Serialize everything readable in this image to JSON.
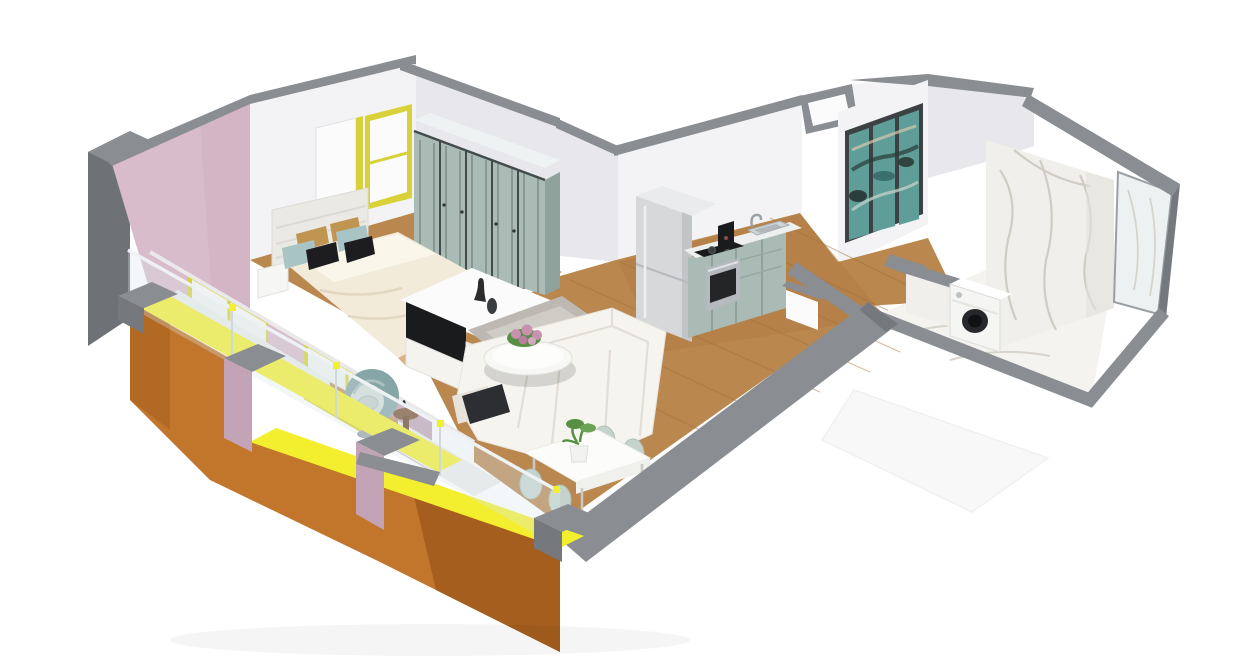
{
  "scene": {
    "title": "Isometric 3D apartment floor plan render",
    "rooms": {
      "bedroom": "Bedroom",
      "living": "Living room",
      "kitchen": "Kitchen",
      "hallway": "Hallway",
      "bathroom": "Bathroom",
      "balcony": "Balcony"
    },
    "furniture": {
      "bed": "Double bed with cream duvet and pillows",
      "wardrobe": "Five-door sage wardrobe",
      "tv": "Wall TV on white media unit",
      "sofa": "White L-shaped sofa",
      "coffee_table": "Round coffee table with pink flowers",
      "dining": "White dining table with four chairs and plant",
      "fridge": "Tall fridge-freezer",
      "kitchen_run": "Kitchen counter with sink, hob and oven",
      "painting": "Teal abstract triptych painting",
      "washer": "Washing machine",
      "egg_chair": "Round egg chair",
      "side_table": "Balcony side table"
    }
  },
  "colors": {
    "bg": "#ffffff",
    "wallWhite": "#f3f3f5",
    "wallBright": "#fbfbfc",
    "wallShade": "#e8e8ec",
    "wallTop": "#8a8d92",
    "wallTopDark": "#75787d",
    "wallDark": "#6e7176",
    "pink": "#d9bccb",
    "pinkShade": "#c3a4b6",
    "orange": "#c1762b",
    "orangeDark": "#a55e1d",
    "yellow": "#f3ef2e",
    "yellowFrame": "#d8d139",
    "wood": "#ba874f",
    "woodDark": "#9f6f3d",
    "rug": "#bdb9b2",
    "rugLight": "#d7d4cf",
    "sage": "#a9bbb4",
    "sageDark": "#8fa29b",
    "trimDark": "#454b4d",
    "counter": "#eef0ef",
    "fridge": "#d6d8da",
    "fridgeShade": "#c2c5c8",
    "steel": "#b5babe",
    "black": "#1a1b1d",
    "sofa": "#f6f4ef",
    "sofaShade": "#e7e2da",
    "duvet": "#f2ebda",
    "headboard": "#ebe9e4",
    "pillowTeal": "#a9c4c4",
    "pillowTan": "#c09551",
    "marble": "#f0efeb",
    "marbleShade": "#e3e1db",
    "vein": "#c6c0b5",
    "paintTeal": "#5f9d98",
    "paintTealDark": "#396f6c",
    "paintInk": "#232e2c",
    "frameDark": "#3c4144",
    "glass": "#d9e6ec",
    "chairTeal": "#86a5a7",
    "chairCushion": "#d5ddd9",
    "chairSage": "#c5d3cd",
    "plant": "#579042",
    "flower": "#c892af",
    "tableWhite": "#fcfcfb",
    "washer": "#f5f5f4",
    "washerDoor": "#26282b"
  }
}
